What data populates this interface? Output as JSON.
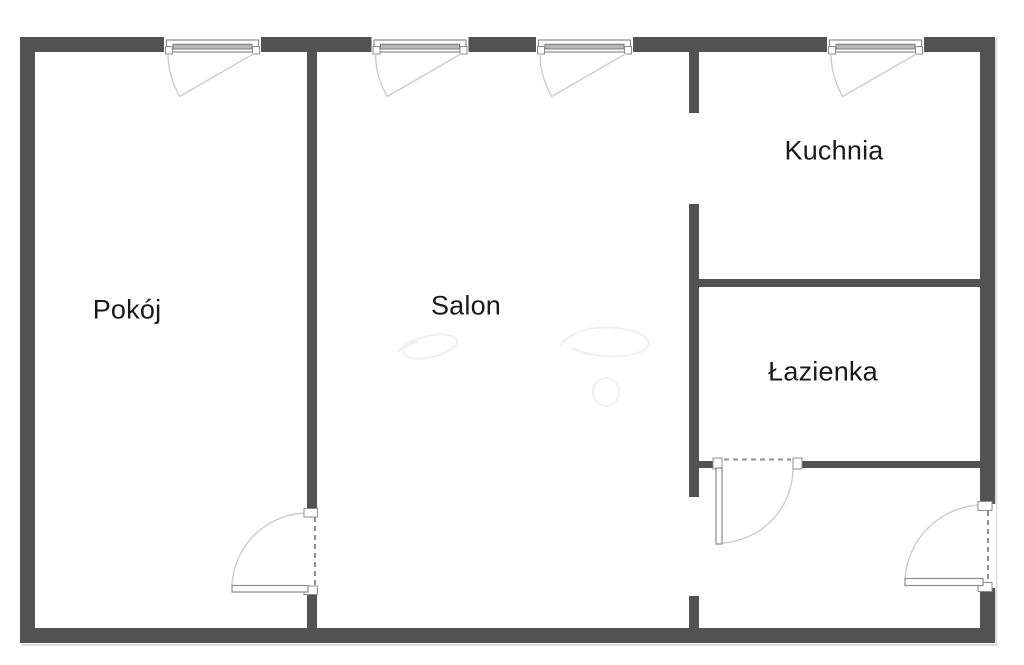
{
  "colors": {
    "wall": "#525252",
    "label": "#1a1a1a",
    "window_glass": "#b9b9b9",
    "symbol_outline": "#8c8c8c",
    "swing_arc": "#cccccc",
    "dash": "#909090"
  },
  "rooms": [
    {
      "name": "pokoj",
      "label": "Pokój"
    },
    {
      "name": "salon",
      "label": "Salon"
    },
    {
      "name": "kuchnia",
      "label": "Kuchnia"
    },
    {
      "name": "lazienka",
      "label": "Łazienka"
    }
  ]
}
